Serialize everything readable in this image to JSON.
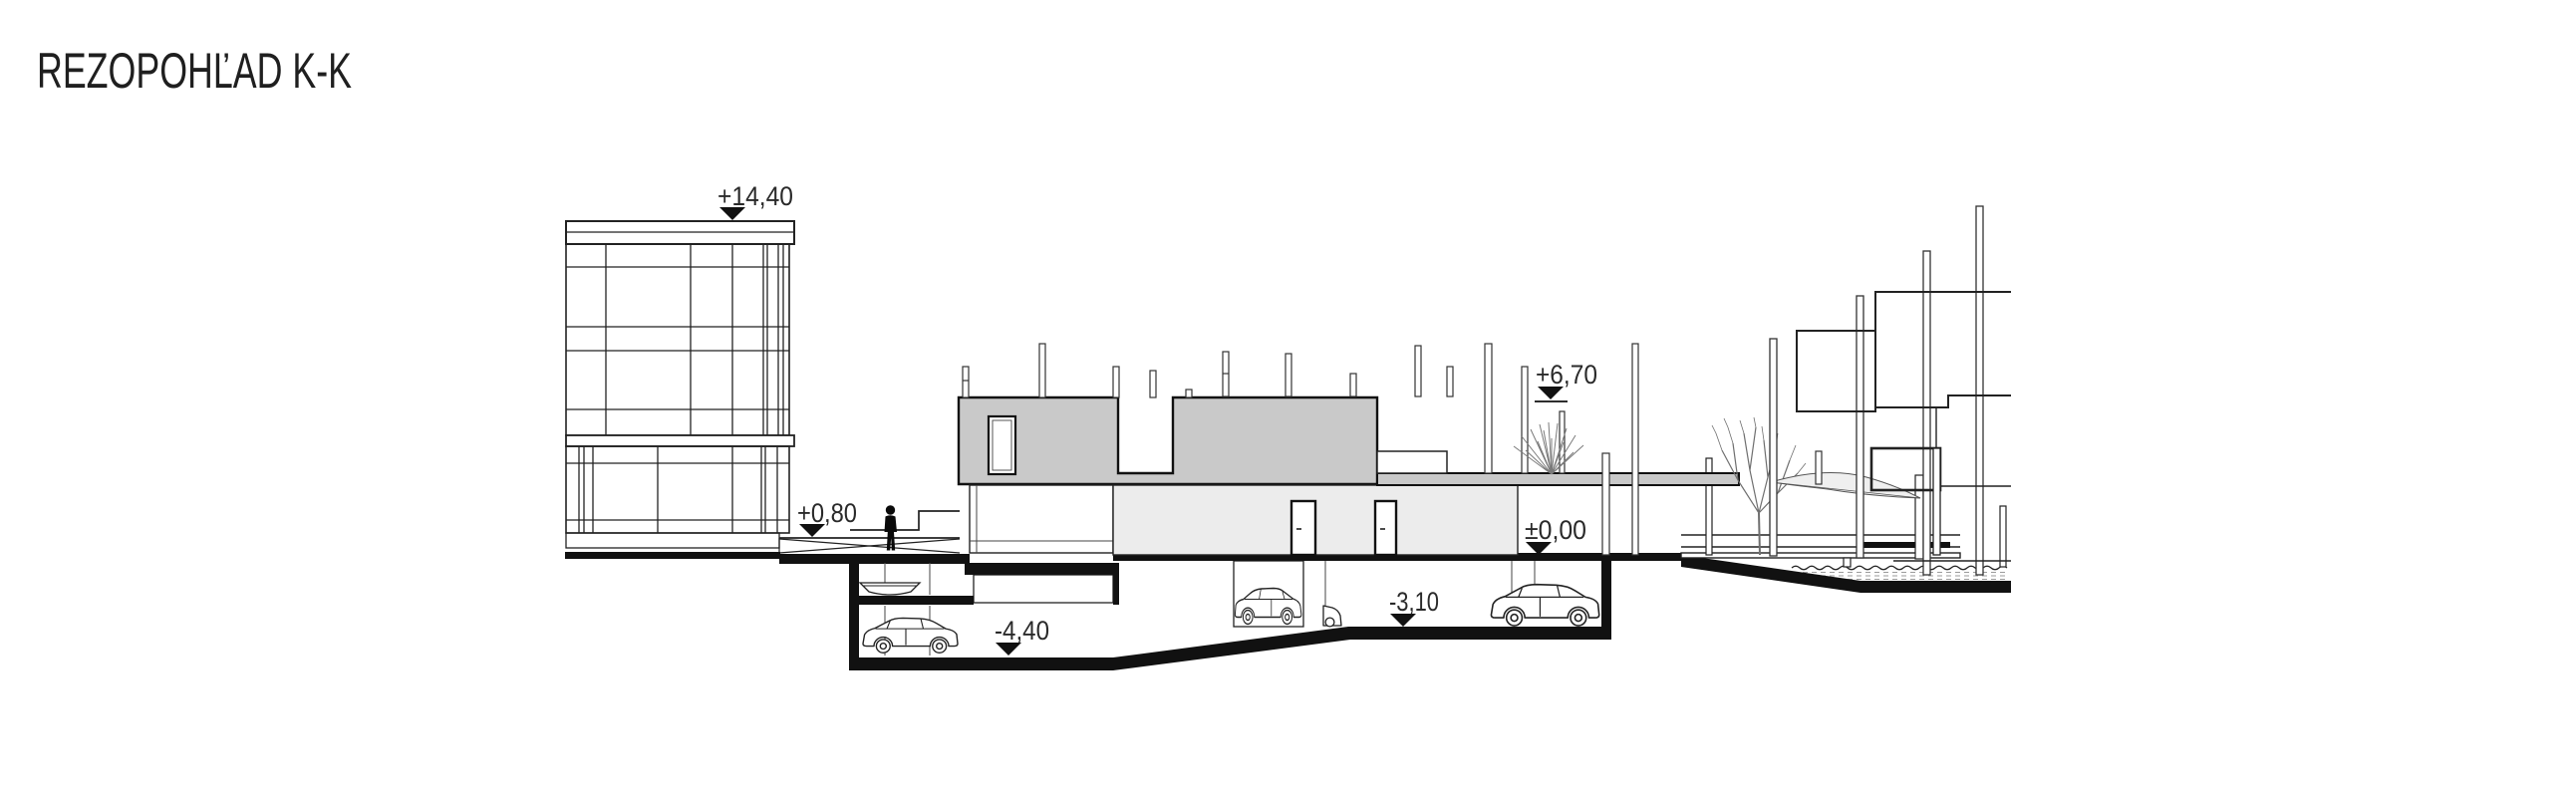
{
  "title": "REZOPOHĽAD K-K",
  "drawing": {
    "kind": "architectural-section-view",
    "section_mark": "K-K",
    "levels": {
      "left_roof": "+14,40",
      "street": "+0,80",
      "central_roof": "+6,70",
      "terrace": "±0,00",
      "garage_mid": "-3,10",
      "garage_low": "-4,40"
    }
  },
  "colors": {
    "background": "#ffffff",
    "ink": "#1a1a1a",
    "upper_floor_fill": "#c9c9c9",
    "ground_floor_fill": "#ececec",
    "poche_fill": "#111111",
    "vegetation": "#777777"
  },
  "figures": {
    "person": "person-silhouette",
    "boat": "boat-outline",
    "cars": [
      "hatchback-left-garage",
      "wagon-center-garage",
      "car-front-partial",
      "suv-right-garage"
    ],
    "trees": [
      "shrub-on-canopy",
      "waterfront-tree"
    ],
    "water": "river-edge-hatch"
  }
}
